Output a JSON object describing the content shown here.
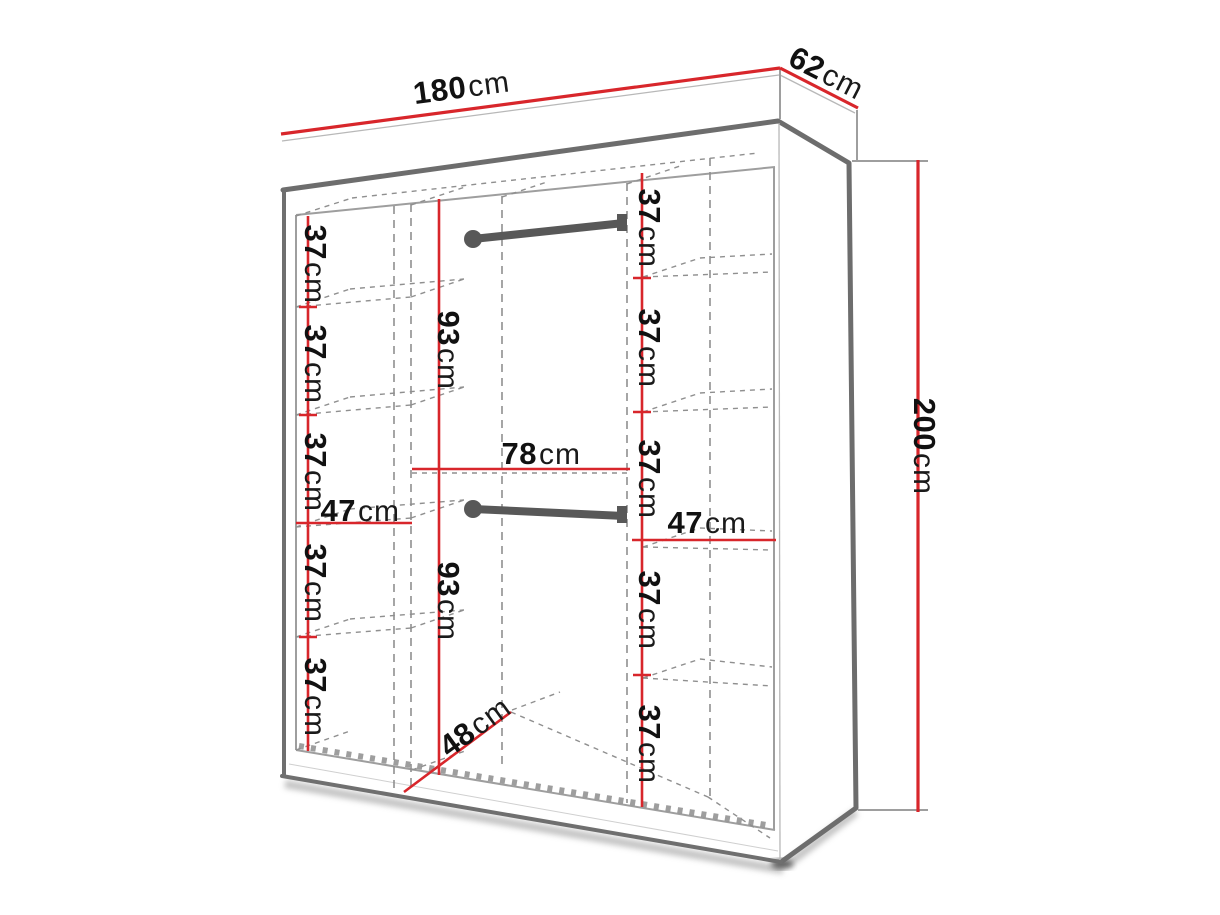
{
  "diagram": {
    "subject": "sliding-wardrobe-interior-dimensions",
    "view": "three-quarter perspective technical drawing",
    "units": "cm"
  },
  "dims": {
    "top_width": {
      "value": "180",
      "unit": "cm"
    },
    "top_depth": {
      "value": "62",
      "unit": "cm"
    },
    "height": {
      "value": "200",
      "unit": "cm"
    },
    "left_column": {
      "width": {
        "value": "47",
        "unit": "cm"
      },
      "compartments": [
        {
          "value": "37",
          "unit": "cm"
        },
        {
          "value": "37",
          "unit": "cm"
        },
        {
          "value": "37",
          "unit": "cm"
        },
        {
          "value": "37",
          "unit": "cm"
        },
        {
          "value": "37",
          "unit": "cm"
        }
      ]
    },
    "middle_column": {
      "width": {
        "value": "78",
        "unit": "cm"
      },
      "floor_depth": {
        "value": "48",
        "unit": "cm"
      },
      "hanging_sections": [
        {
          "value": "93",
          "unit": "cm"
        },
        {
          "value": "93",
          "unit": "cm"
        }
      ]
    },
    "right_column": {
      "width": {
        "value": "47",
        "unit": "cm"
      },
      "compartments": [
        {
          "value": "37",
          "unit": "cm"
        },
        {
          "value": "37",
          "unit": "cm"
        },
        {
          "value": "37",
          "unit": "cm"
        },
        {
          "value": "37",
          "unit": "cm"
        },
        {
          "value": "37",
          "unit": "cm"
        }
      ]
    }
  },
  "colors": {
    "dimension_line": "#d8262b",
    "outline_dark": "#6d6d6d",
    "outline_light": "#9e9e9e",
    "hidden_line": "#8f8f8f",
    "rod": "#585858",
    "text": "#111111",
    "shadow": "#b4b4b4",
    "background": "#ffffff"
  }
}
